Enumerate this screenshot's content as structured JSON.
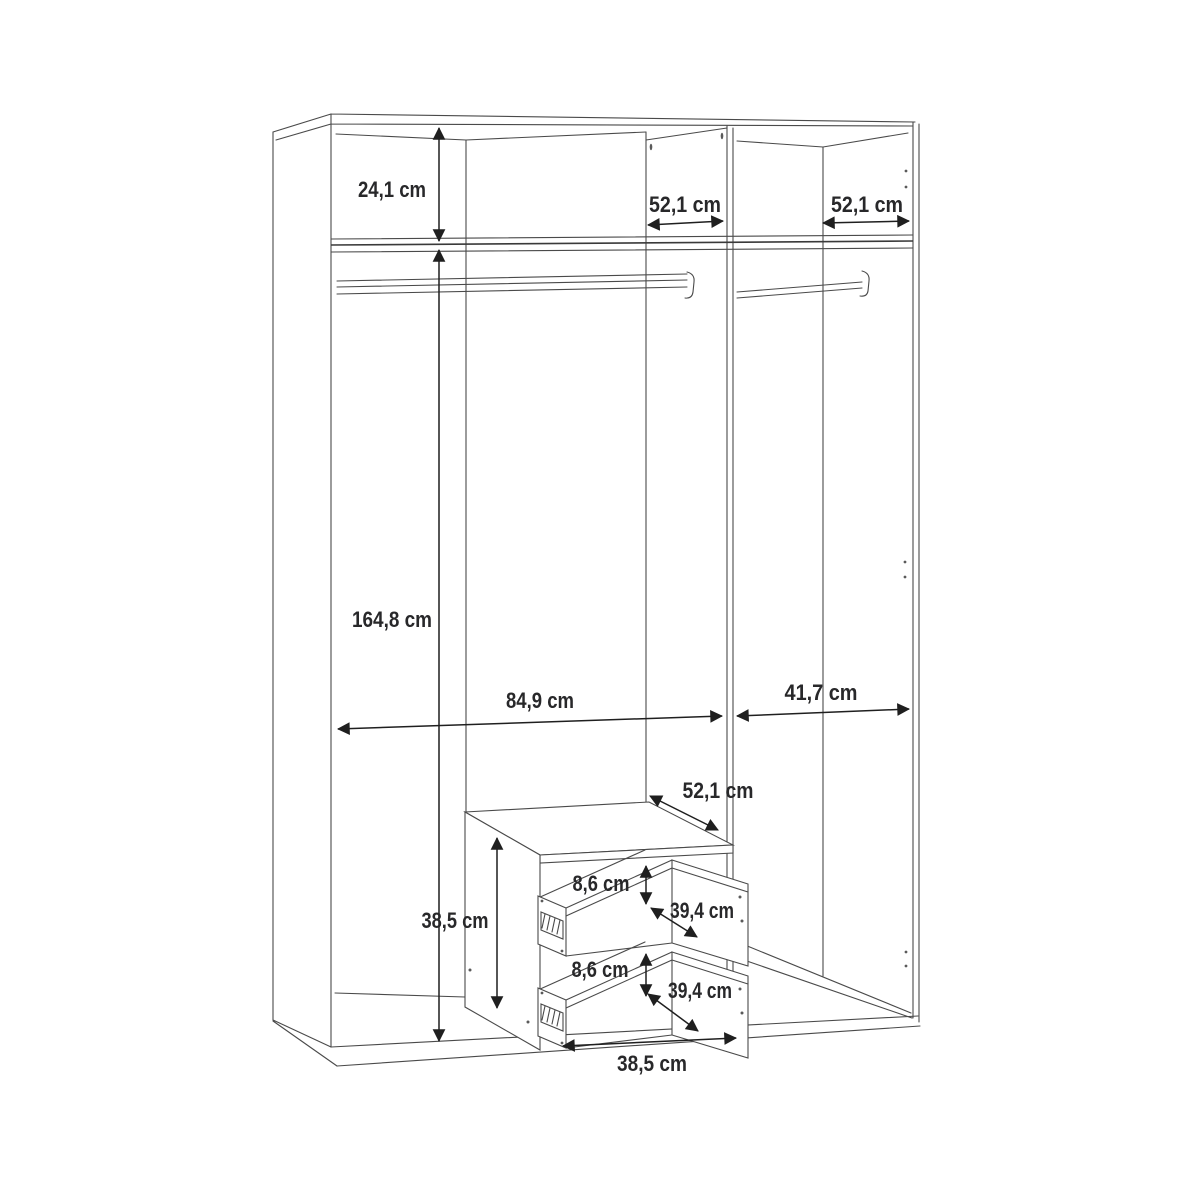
{
  "diagram": {
    "type": "furniture-dimension-drawing",
    "subject": "wardrobe-interior",
    "unit": "cm",
    "line_color": "#4a4a4a",
    "dimension_color": "#1f1f1f",
    "background_color": "#ffffff",
    "labels": {
      "top_section_height": "24,1 cm",
      "divider_depth": "52,1 cm",
      "right_top_depth": "52,1 cm",
      "interior_height": "164,8 cm",
      "left_section_width": "84,9 cm",
      "right_section_width": "41,7 cm",
      "drawer_unit_depth": "52,1 cm",
      "drawer_unit_height": "38,5 cm",
      "drawer1_front_height": "8,6 cm",
      "drawer1_depth": "39,4 cm",
      "drawer2_front_height": "8,6 cm",
      "drawer2_depth": "39,4 cm",
      "drawer_unit_width": "38,5 cm"
    }
  }
}
